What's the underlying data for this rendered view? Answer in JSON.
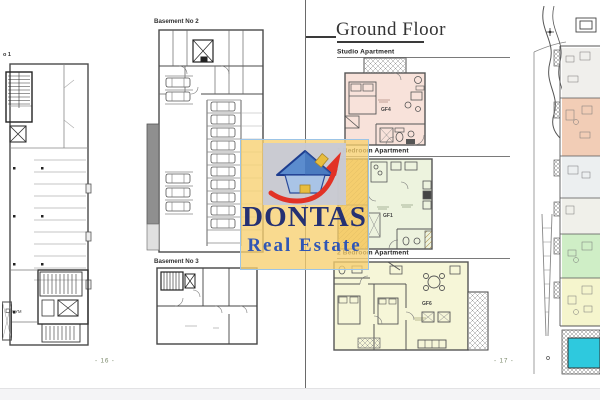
{
  "document": {
    "left_page": {
      "basement1_label_fragment": "o 1",
      "basement2_label": "Basement No 2",
      "basement3_label": "Basement No 3",
      "gym_label": "GYM",
      "page_number": "- 16 -"
    },
    "right_page": {
      "title": "Ground Floor",
      "studio": {
        "label": "Studio Apartment",
        "unit": "GF4"
      },
      "one_bedroom": {
        "label": "1 Bedroom Apartment",
        "unit": "GF1"
      },
      "two_bedroom": {
        "label": "2 Bedroom Apartment",
        "unit": "GF6"
      },
      "page_number": "- 17 -"
    },
    "watermark": {
      "brand": "DONTAS",
      "tagline": "Real Estate"
    },
    "colors": {
      "studio_fill": "#F8E2DA",
      "one_bed_fill": "#EDF3DE",
      "terrace_fill": "#EBC968",
      "two_bed_fill": "#F6F6D8",
      "site_salmon": "#F2CDB6",
      "site_green": "#CFEEC6",
      "site_yellow": "#F5F5CD",
      "pool_blue": "#2EC9DE",
      "watermark_yellow": "#F7D070",
      "brand_navy": "#253173",
      "brand_blue": "#3056B5",
      "page_number_green": "#7B8A6B"
    }
  }
}
